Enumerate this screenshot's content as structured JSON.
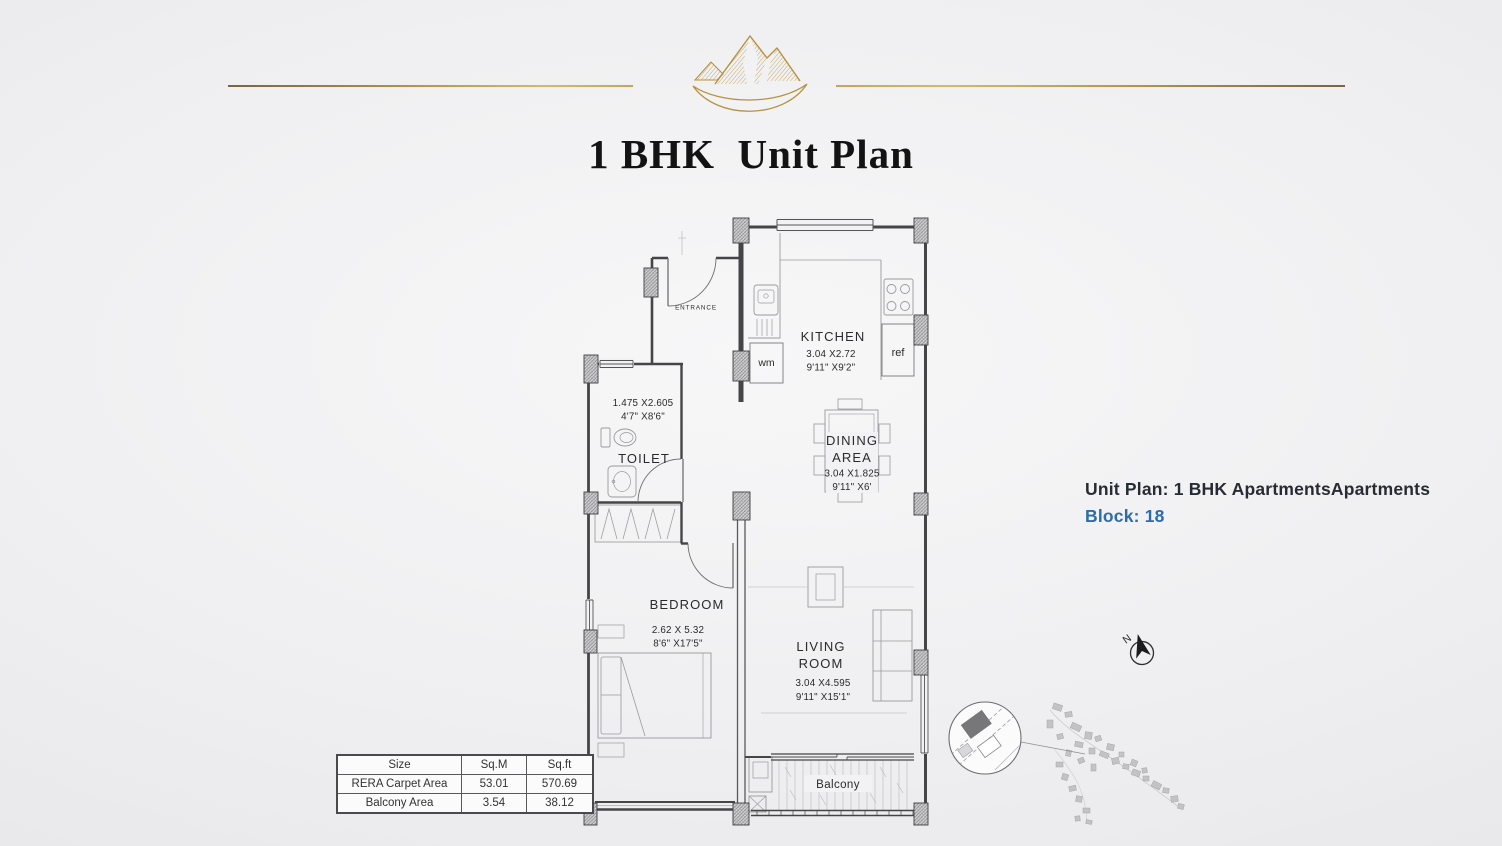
{
  "colors": {
    "gold": "#b99146",
    "accent_blue": "#2d6ca8",
    "title_color": "#131313",
    "wall_color": "#454548"
  },
  "header": {
    "logo_icon": "mountain-logo-icon",
    "title": "1 BHK  Unit Plan"
  },
  "info_panel": {
    "line1": "Unit Plan: 1 BHK ApartmentsApartments",
    "line2": "Block: 18"
  },
  "compass": {
    "north_label": "N"
  },
  "floor_plan": {
    "entrance_label": "ENTRANCE",
    "kitchen": {
      "name": "KITCHEN",
      "dim_m": "3.04 X2.72",
      "dim_ft": "9'11\" X9'2\""
    },
    "dining": {
      "name_line1": "DINING",
      "name_line2": "AREA",
      "dim_m": "3.04 X1.825",
      "dim_ft": "9'11\" X6'"
    },
    "toilet": {
      "name": "TOILET",
      "dim_m": "1.475 X2.605",
      "dim_ft": "4'7\" X8'6\""
    },
    "bedroom": {
      "name": "BEDROOM",
      "dim_m": "2.62 X 5.32",
      "dim_ft": "8'6\" X17'5\""
    },
    "living": {
      "name_line1": "LIVING",
      "name_line2": "ROOM",
      "dim_m": "3.04 X4.595",
      "dim_ft": "9'11\" X15'1\""
    },
    "balcony": {
      "name": "Balcony"
    },
    "appliances": {
      "wm": "wm",
      "ref": "ref"
    }
  },
  "area_table": {
    "headers": [
      "Size",
      "Sq.M",
      "Sq.ft"
    ],
    "rows": [
      {
        "label": "RERA Carpet Area",
        "sqm": "53.01",
        "sqft": "570.69"
      },
      {
        "label": "Balcony Area",
        "sqm": "3.54",
        "sqft": "38.12"
      }
    ]
  }
}
